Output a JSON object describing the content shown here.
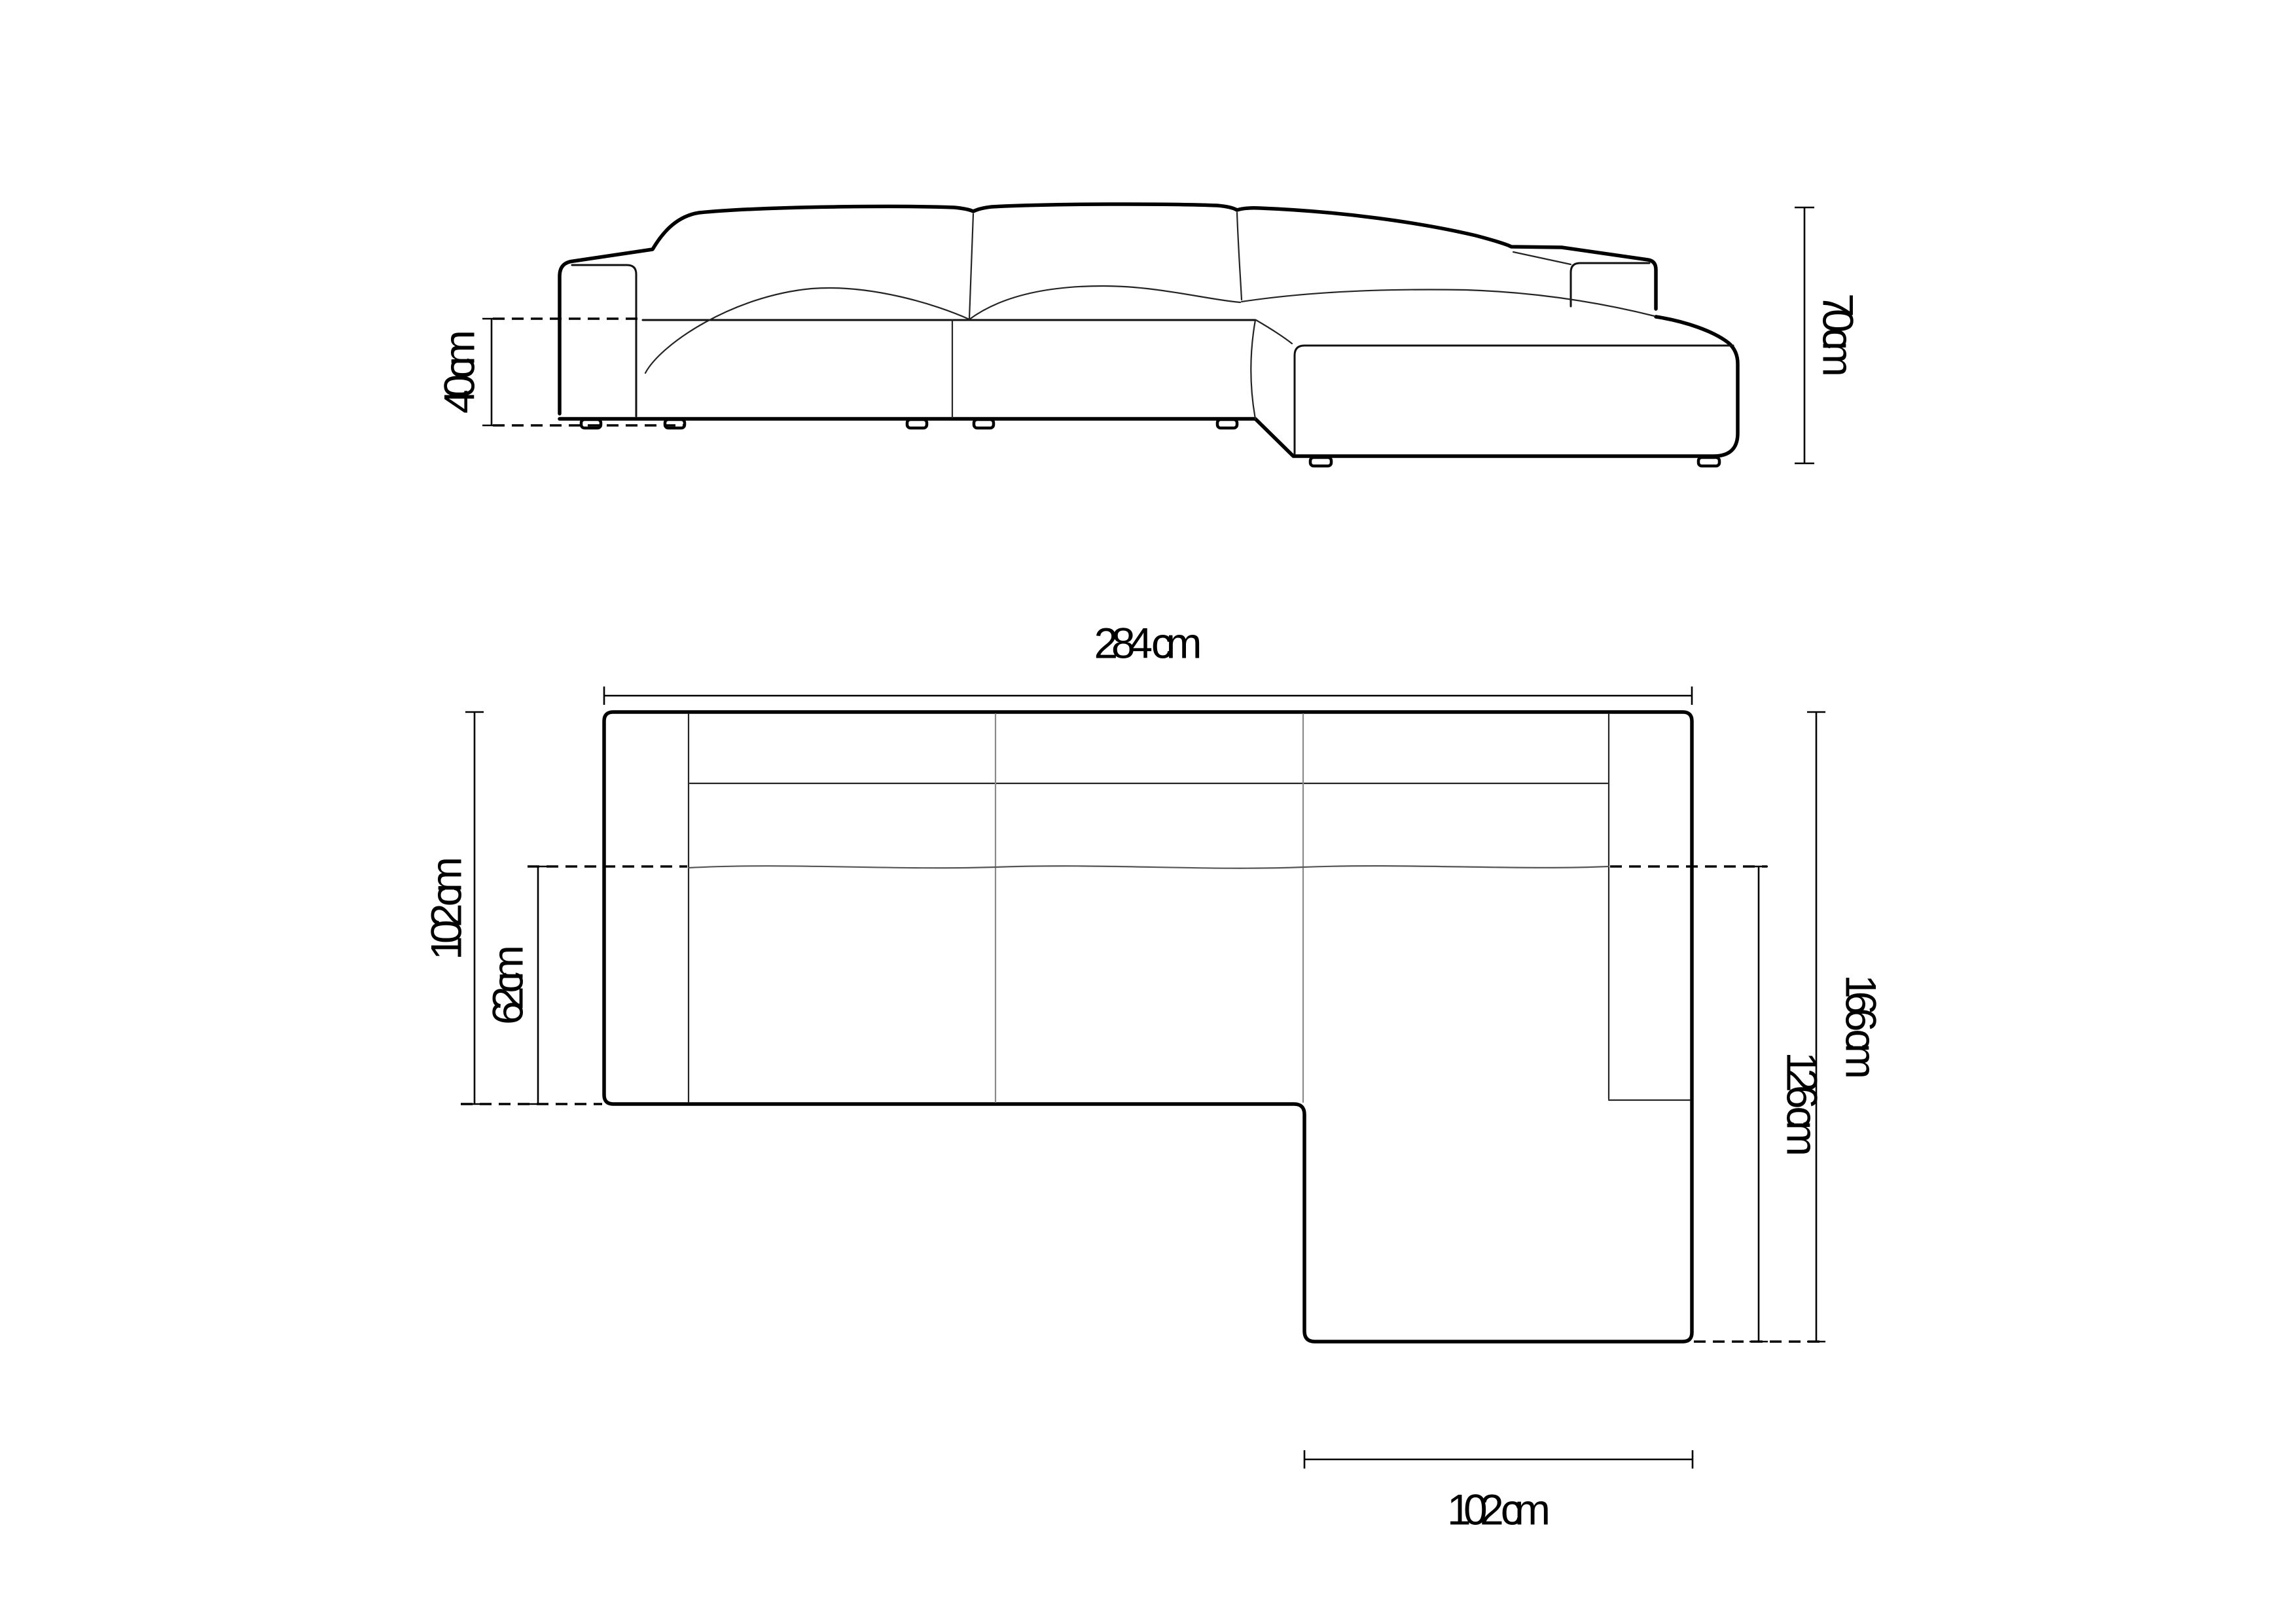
{
  "page": {
    "background": "#ffffff",
    "line_color": "#000000",
    "unit": "cm",
    "description": "sofa-dimension-technical-drawing"
  },
  "front_view": {
    "seat_height_label": "40 cm",
    "total_height_label": "70 cm"
  },
  "top_view": {
    "total_width_label": "284 cm",
    "side_depth_label": "102 cm",
    "seat_depth_label": "62 cm",
    "chaise_total_depth_label": "166 cm",
    "chaise_inner_depth_label": "126 cm",
    "chaise_width_label": "102 cm"
  }
}
